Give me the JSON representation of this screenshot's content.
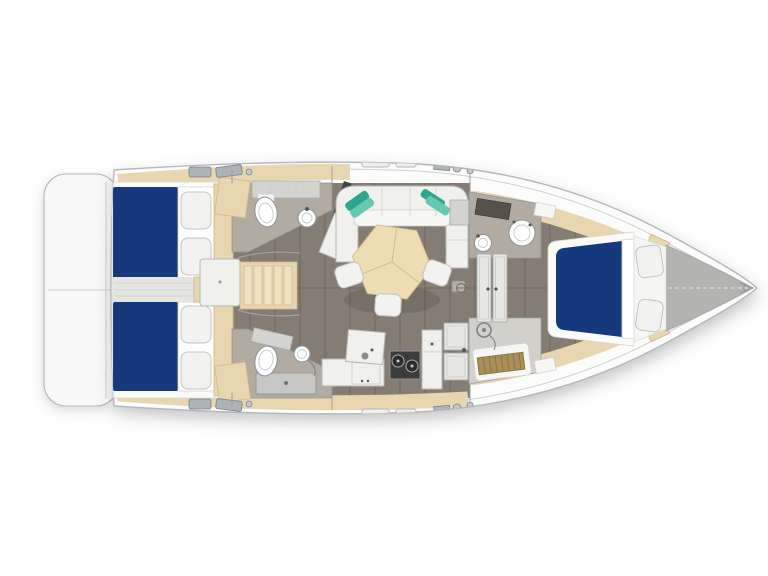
{
  "diagram": {
    "kind": "sailing-yacht-interior-floor-plan",
    "view": "top-down",
    "bow_direction": "right"
  },
  "colors": {
    "page_bg": "#ffffff",
    "hull_fill": "#fcfcfb",
    "hull_stroke": "#b4b8bb",
    "deck_line": "#ccd0d2",
    "platform_fill": "#f7f8f7",
    "floor": "#857d73",
    "floor_seam": "#3a332c",
    "corridor": "#e4e4e1",
    "head_floor": "#b2aba1",
    "bed_blue": "#16397e",
    "tan": "#e7d6b0",
    "tan_stroke": "#cdb88c",
    "table_tan": "#eedcb2",
    "table_stroke": "#d3bd8e",
    "furniture": "#f0f0ed",
    "furniture_stroke": "#b8b8b3",
    "fixture_stroke": "#8f9598",
    "dark_panel": "#454440",
    "stove": "#3c3c3a",
    "steel": "#aeb3b6",
    "teak": "#a98e58",
    "teal": "#2ea58e",
    "teal_light": "#66c7b2",
    "bow_deck": "#b3b3b0",
    "white": "#ffffff"
  },
  "components": {
    "cabins": [
      {
        "id": "aft-cabin-port",
        "berth": "double, blue mattress",
        "pillows": 2
      },
      {
        "id": "aft-cabin-starboard",
        "berth": "double, blue mattress",
        "pillows": 2
      },
      {
        "id": "forward-cabin",
        "berth": "double island berth, blue mattress",
        "pillows": 2
      }
    ],
    "wet_rooms": [
      {
        "id": "aft-head-port",
        "fixtures": [
          "toilet",
          "sink",
          "vanity counter"
        ]
      },
      {
        "id": "aft-head-starboard",
        "fixtures": [
          "toilet",
          "sink",
          "shower tray"
        ]
      },
      {
        "id": "forward-head",
        "fixtures": [
          "toilet",
          "sink",
          "vanity counter"
        ]
      },
      {
        "id": "forward-shower-room",
        "fixtures": [
          "shower",
          "teak grate floor"
        ]
      }
    ],
    "salon": {
      "sofa": "C-shaped with teal accent pillows",
      "table": "hexagonal dinette table",
      "stools": 3
    },
    "galley": {
      "fixtures": [
        "counter",
        "round sink",
        "two-burner stove",
        "locker column",
        "louvered door"
      ]
    },
    "other": [
      "swim-platform",
      "companionway-steps",
      "engine-box",
      "bow-anchor-locker",
      "deck-hatches",
      "winches"
    ]
  }
}
